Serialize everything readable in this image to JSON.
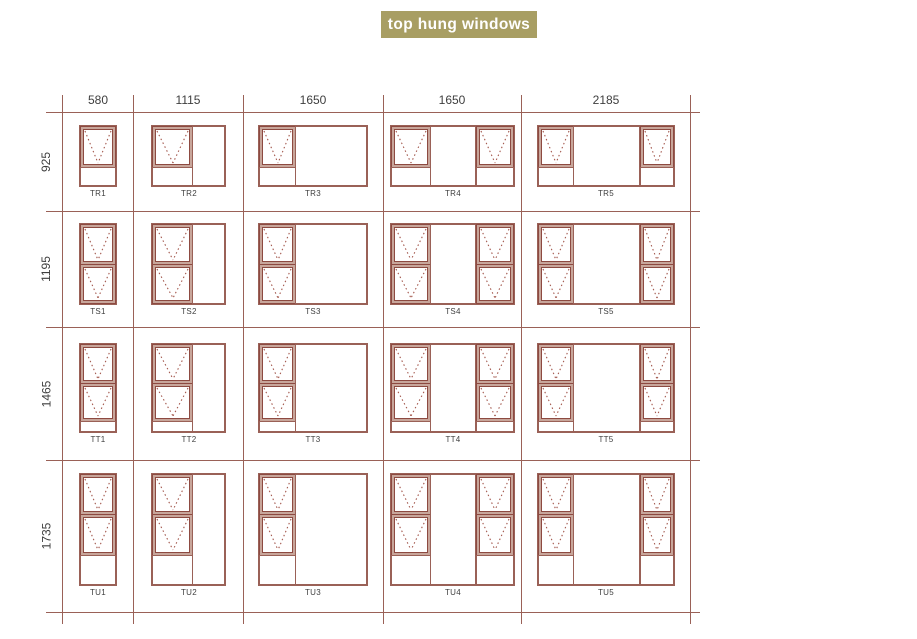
{
  "title": {
    "label": "top hung windows"
  },
  "colors": {
    "banner_bg": "#a89e63",
    "banner_fg": "#ffffff",
    "grid_line": "#9a6157",
    "frame_line": "#9a6157",
    "sash_border": "#8d4a41",
    "sash_fill": "#c8a69b",
    "vent_dotted": "#a3574c",
    "text": "#3e3e3e"
  },
  "grid": {
    "col_boundaries": [
      62,
      133,
      243,
      383,
      521,
      690
    ],
    "row_boundaries": [
      112,
      211,
      327,
      460,
      612
    ],
    "h_line_x0": 46,
    "h_line_x1": 700,
    "v_line_y0": 95,
    "v_line_y1": 624,
    "col_labels": [
      "580",
      "1115",
      "1650",
      "1650",
      "2185"
    ],
    "row_labels": [
      "925",
      "1195",
      "1465",
      "1735"
    ]
  },
  "win_widths": [
    38,
    75,
    110,
    125,
    138
  ],
  "rows": [
    {
      "prefix": "TR",
      "height_label": "925",
      "win_h": 62,
      "top_off": 13,
      "v_layout": [
        {
          "kind": "sash",
          "f": 0.68
        },
        {
          "kind": "fixed",
          "f": 0.32
        }
      ]
    },
    {
      "prefix": "TS",
      "height_label": "1195",
      "win_h": 82,
      "top_off": 12,
      "v_layout": [
        {
          "kind": "sash",
          "f": 0.5
        },
        {
          "kind": "sash",
          "f": 0.5
        }
      ]
    },
    {
      "prefix": "TT",
      "height_label": "1465",
      "win_h": 90,
      "top_off": 16,
      "v_layout": [
        {
          "kind": "sash",
          "f": 0.445
        },
        {
          "kind": "sash",
          "f": 0.42
        },
        {
          "kind": "fixed",
          "f": 0.135
        }
      ]
    },
    {
      "prefix": "TU",
      "height_label": "1735",
      "win_h": 113,
      "top_off": 13,
      "v_layout": [
        {
          "kind": "sash",
          "f": 0.36
        },
        {
          "kind": "sash",
          "f": 0.36
        },
        {
          "kind": "fixed",
          "f": 0.28
        }
      ]
    }
  ],
  "cells": [
    {
      "code": "TR1",
      "row": 0,
      "col": 0,
      "panes": [
        {
          "kind": "unit",
          "w": 1
        }
      ]
    },
    {
      "code": "TR2",
      "row": 0,
      "col": 1,
      "panes": [
        {
          "kind": "unit",
          "w": 0.55
        },
        {
          "kind": "fixed",
          "w": 0.45
        }
      ]
    },
    {
      "code": "TR3",
      "row": 0,
      "col": 2,
      "panes": [
        {
          "kind": "unit",
          "w": 0.34
        },
        {
          "kind": "fixed",
          "w": 0.66
        }
      ]
    },
    {
      "code": "TR4",
      "row": 0,
      "col": 3,
      "panes": [
        {
          "kind": "unit",
          "w": 0.32
        },
        {
          "kind": "fixed",
          "w": 0.36
        },
        {
          "kind": "unit",
          "w": 0.32
        }
      ]
    },
    {
      "code": "TR5",
      "row": 0,
      "col": 4,
      "panes": [
        {
          "kind": "unit",
          "w": 0.26
        },
        {
          "kind": "fixed",
          "w": 0.48
        },
        {
          "kind": "unit",
          "w": 0.26
        }
      ]
    },
    {
      "code": "TS1",
      "row": 1,
      "col": 0,
      "panes": [
        {
          "kind": "unit",
          "w": 1
        }
      ]
    },
    {
      "code": "TS2",
      "row": 1,
      "col": 1,
      "panes": [
        {
          "kind": "unit",
          "w": 0.55
        },
        {
          "kind": "fixed",
          "w": 0.45
        }
      ]
    },
    {
      "code": "TS3",
      "row": 1,
      "col": 2,
      "panes": [
        {
          "kind": "unit",
          "w": 0.34
        },
        {
          "kind": "fixed",
          "w": 0.66
        }
      ]
    },
    {
      "code": "TS4",
      "row": 1,
      "col": 3,
      "panes": [
        {
          "kind": "unit",
          "w": 0.32
        },
        {
          "kind": "fixed",
          "w": 0.36
        },
        {
          "kind": "unit",
          "w": 0.32
        }
      ]
    },
    {
      "code": "TS5",
      "row": 1,
      "col": 4,
      "panes": [
        {
          "kind": "unit",
          "w": 0.26
        },
        {
          "kind": "fixed",
          "w": 0.48
        },
        {
          "kind": "unit",
          "w": 0.26
        }
      ]
    },
    {
      "code": "TT1",
      "row": 2,
      "col": 0,
      "panes": [
        {
          "kind": "unit",
          "w": 1
        }
      ]
    },
    {
      "code": "TT2",
      "row": 2,
      "col": 1,
      "panes": [
        {
          "kind": "unit",
          "w": 0.55
        },
        {
          "kind": "fixed",
          "w": 0.45
        }
      ]
    },
    {
      "code": "TT3",
      "row": 2,
      "col": 2,
      "panes": [
        {
          "kind": "unit",
          "w": 0.34
        },
        {
          "kind": "fixed",
          "w": 0.66
        }
      ]
    },
    {
      "code": "TT4",
      "row": 2,
      "col": 3,
      "panes": [
        {
          "kind": "unit",
          "w": 0.32
        },
        {
          "kind": "fixed",
          "w": 0.36
        },
        {
          "kind": "unit",
          "w": 0.32
        }
      ]
    },
    {
      "code": "TT5",
      "row": 2,
      "col": 4,
      "panes": [
        {
          "kind": "unit",
          "w": 0.26
        },
        {
          "kind": "fixed",
          "w": 0.48
        },
        {
          "kind": "unit",
          "w": 0.26
        }
      ]
    },
    {
      "code": "TU1",
      "row": 3,
      "col": 0,
      "panes": [
        {
          "kind": "unit",
          "w": 1
        }
      ]
    },
    {
      "code": "TU2",
      "row": 3,
      "col": 1,
      "panes": [
        {
          "kind": "unit",
          "w": 0.55
        },
        {
          "kind": "fixed",
          "w": 0.45
        }
      ]
    },
    {
      "code": "TU3",
      "row": 3,
      "col": 2,
      "panes": [
        {
          "kind": "unit",
          "w": 0.34
        },
        {
          "kind": "fixed",
          "w": 0.66
        }
      ]
    },
    {
      "code": "TU4",
      "row": 3,
      "col": 3,
      "panes": [
        {
          "kind": "unit",
          "w": 0.32
        },
        {
          "kind": "fixed",
          "w": 0.36
        },
        {
          "kind": "unit",
          "w": 0.32
        }
      ]
    },
    {
      "code": "TU5",
      "row": 3,
      "col": 4,
      "panes": [
        {
          "kind": "unit",
          "w": 0.26
        },
        {
          "kind": "fixed",
          "w": 0.48
        },
        {
          "kind": "unit",
          "w": 0.26
        }
      ]
    }
  ]
}
